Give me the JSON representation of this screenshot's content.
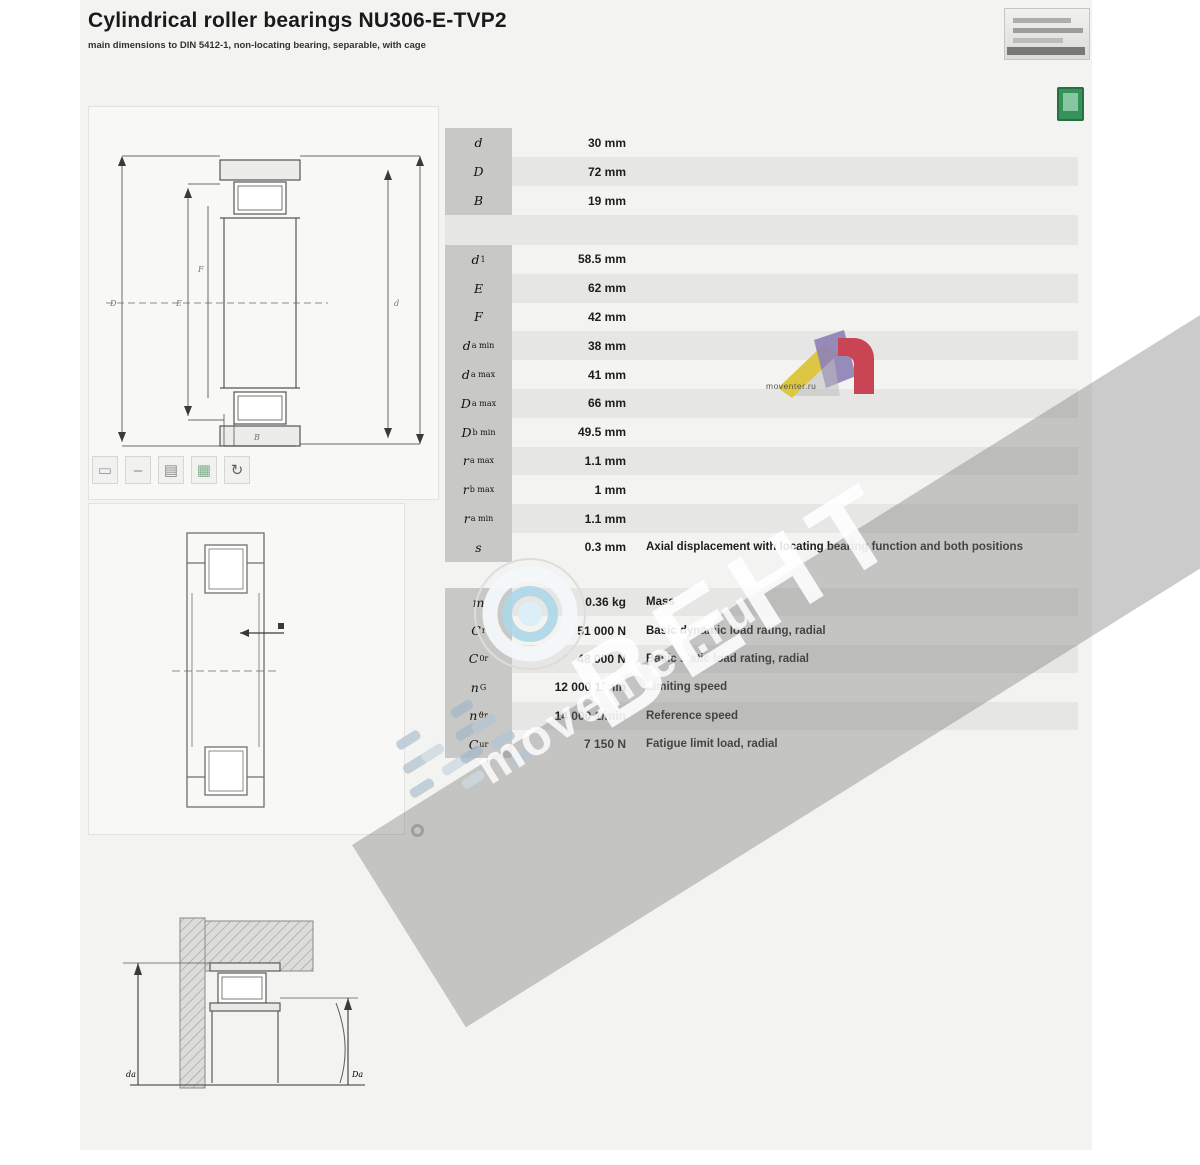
{
  "header": {
    "title": "Cylindrical roller bearings NU306-E-TVP2",
    "subtitle": "main dimensions to DIN 5412-1, non-locating bearing, separable, with cage"
  },
  "tables": [
    {
      "name": "main-dimensions",
      "rows": [
        {
          "label": "d",
          "sub": "",
          "value": "30 mm",
          "desc": ""
        },
        {
          "label": "D",
          "sub": "",
          "value": "72 mm",
          "desc": ""
        },
        {
          "label": "B",
          "sub": "",
          "value": "19 mm",
          "desc": ""
        }
      ]
    },
    {
      "name": "dimensions-mounting",
      "rows": [
        {
          "label": "d",
          "sub": "1",
          "value": "58.5 mm",
          "desc": ""
        },
        {
          "label": "E",
          "sub": "",
          "value": "62 mm",
          "desc": ""
        },
        {
          "label": "F",
          "sub": "",
          "value": "42 mm",
          "desc": ""
        },
        {
          "label": "d",
          "sub": "a min",
          "value": "38 mm",
          "desc": ""
        },
        {
          "label": "d",
          "sub": "a max",
          "value": "41 mm",
          "desc": ""
        },
        {
          "label": "D",
          "sub": "a max",
          "value": "66 mm",
          "desc": ""
        },
        {
          "label": "D",
          "sub": "b min",
          "value": "49.5 mm",
          "desc": ""
        },
        {
          "label": "r",
          "sub": "a max",
          "value": "1.1 mm",
          "desc": ""
        },
        {
          "label": "r",
          "sub": "b max",
          "value": "1 mm",
          "desc": ""
        },
        {
          "label": "r",
          "sub": "a min",
          "value": "1.1 mm",
          "desc": ""
        },
        {
          "label": "s",
          "sub": "",
          "value": "0.3 mm",
          "desc": "Axial displacement with locating bearing function and both positions"
        }
      ]
    },
    {
      "name": "performance-data",
      "rows": [
        {
          "label": "m",
          "sub": "",
          "value": "0.36 kg",
          "desc": "Mass"
        },
        {
          "label": "C",
          "sub": "r",
          "value": "51 000 N",
          "desc": "Basic dynamic load rating, radial"
        },
        {
          "label": "C",
          "sub": "0r",
          "value": "48 000 N",
          "desc": "Basic static load rating, radial"
        },
        {
          "label": "n",
          "sub": "G",
          "value": "12 000 1/min",
          "desc": "Limiting speed"
        },
        {
          "label": "n",
          "sub": "ϑr",
          "value": "14 000 1/min",
          "desc": "Reference speed"
        },
        {
          "label": "C",
          "sub": "ur",
          "value": "7 150 N",
          "desc": "Fatigue limit load, radial"
        }
      ]
    }
  ],
  "diagrams": {
    "top": {
      "labels": [
        "D",
        "E",
        "F",
        "d",
        "B"
      ]
    },
    "bottom": {
      "labels": [
        "da",
        "Da"
      ]
    }
  },
  "feature_icons": [
    {
      "name": "section-pair-icon",
      "glyph": "▭",
      "color": "#8a9aa6"
    },
    {
      "name": "divider-icon",
      "glyph": "–",
      "color": "#7a8a7a"
    },
    {
      "name": "pattern-box-icon",
      "glyph": "▤",
      "color": "#8a8a88"
    },
    {
      "name": "lubrication-icon",
      "glyph": "▦",
      "color": "#7fae8c"
    },
    {
      "name": "rotation-arrow-icon",
      "glyph": "↻",
      "color": "#55695a"
    }
  ],
  "watermark": {
    "brand_text": "ВЕНТ",
    "site_text": "moventer.ru",
    "caption": "moventer.ru"
  },
  "colors": {
    "stripe": "#e6e6e4",
    "label_column": "#c8c8c6",
    "green_icon": "#37915a",
    "watermark_band": "rgba(125,125,125,0.40)",
    "logo_yellow": "#ddc742",
    "logo_purple": "#8e82b5",
    "logo_red": "#c94553",
    "watermark_blue": "#b7c6d2"
  }
}
